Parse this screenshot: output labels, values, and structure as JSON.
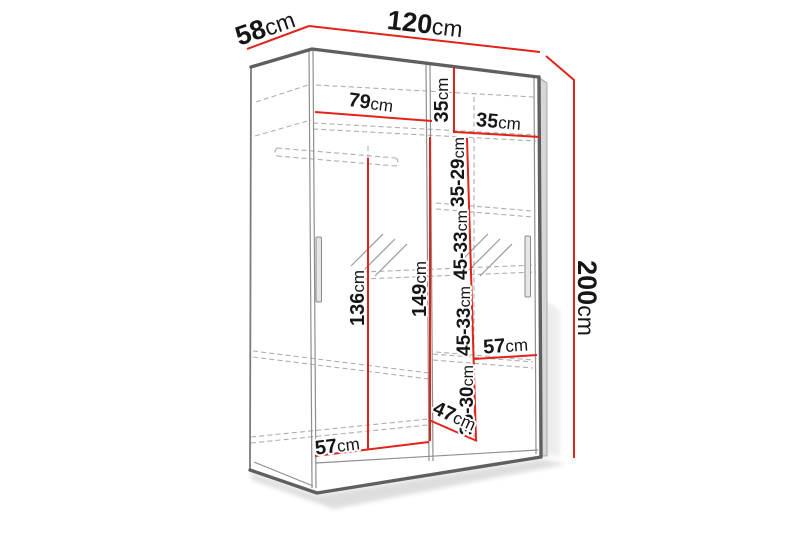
{
  "diagram_title": "wardrobe-dimension-diagram",
  "colors": {
    "dimension_accent": "#e2231a",
    "outline_gray": "#5f5f5f",
    "hidden_line_gray": "#aeaeae",
    "background": "#ffffff"
  },
  "dimensions": {
    "depth_top": {
      "value": "58",
      "unit": "cm"
    },
    "width_top": {
      "value": "120",
      "unit": "cm"
    },
    "height_right": {
      "value": "200",
      "unit": "cm"
    },
    "left_section_width": {
      "value": "79",
      "unit": "cm"
    },
    "top_shelf_height": {
      "value": "35",
      "unit": "cm"
    },
    "right_section_width": {
      "value": "35",
      "unit": "cm"
    },
    "shelf_gap_1": {
      "value": "35-29",
      "unit": "cm"
    },
    "shelf_gap_2": {
      "value": "45-33",
      "unit": "cm"
    },
    "shelf_gap_3": {
      "value": "45-33",
      "unit": "cm"
    },
    "shelf_gap_4": {
      "value": "36-30",
      "unit": "cm"
    },
    "hanging_space_height": {
      "value": "136",
      "unit": "cm"
    },
    "interior_height": {
      "value": "149",
      "unit": "cm"
    },
    "lower_shelf_width": {
      "value": "57",
      "unit": "cm"
    },
    "bottom_diagonal": {
      "value": "47",
      "unit": "cm"
    },
    "bottom_section_width": {
      "value": "57",
      "unit": "cm"
    }
  }
}
